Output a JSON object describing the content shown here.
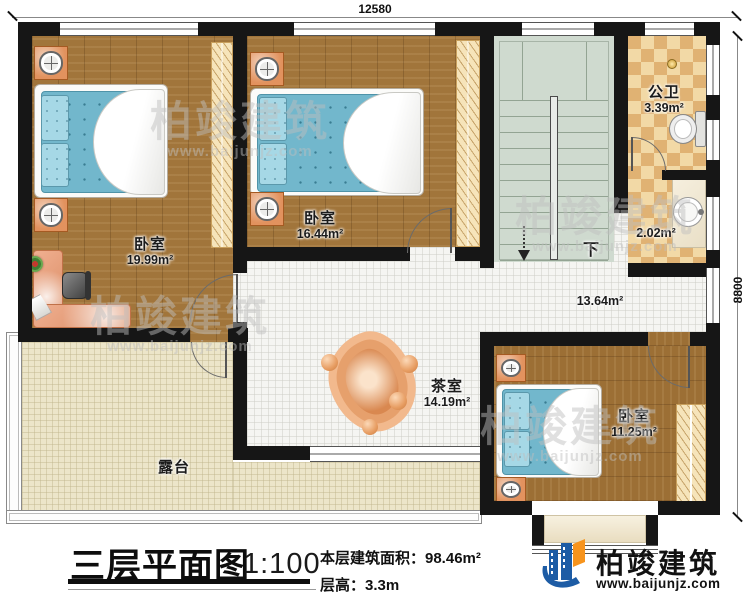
{
  "dimensions": {
    "top": "12580",
    "right": "8800"
  },
  "rooms": {
    "bedroom1": {
      "name": "卧室",
      "area": "19.99m²"
    },
    "bedroom2": {
      "name": "卧室",
      "area": "16.44m²"
    },
    "bedroom3": {
      "name": "卧室",
      "area": "11.25m²"
    },
    "bathroom": {
      "name": "公卫",
      "area": "3.39m²"
    },
    "washroom": {
      "area": "2.02m²"
    },
    "hallway": {
      "area": "13.64m²"
    },
    "tearoom": {
      "name": "茶室",
      "area": "14.19m²"
    },
    "terrace": {
      "name": "露台"
    }
  },
  "stairs": {
    "direction_label": "下"
  },
  "title_block": {
    "title": "三层平面图",
    "scale": "1:100",
    "floor_area": "本层建筑面积：98.46m²",
    "floor_height": "层高：3.3m"
  },
  "logo": {
    "company": "柏竣建筑",
    "website": "www.baijunjz.com"
  },
  "watermark": {
    "company": "柏竣建筑",
    "website": "www.baijunjz.com"
  }
}
